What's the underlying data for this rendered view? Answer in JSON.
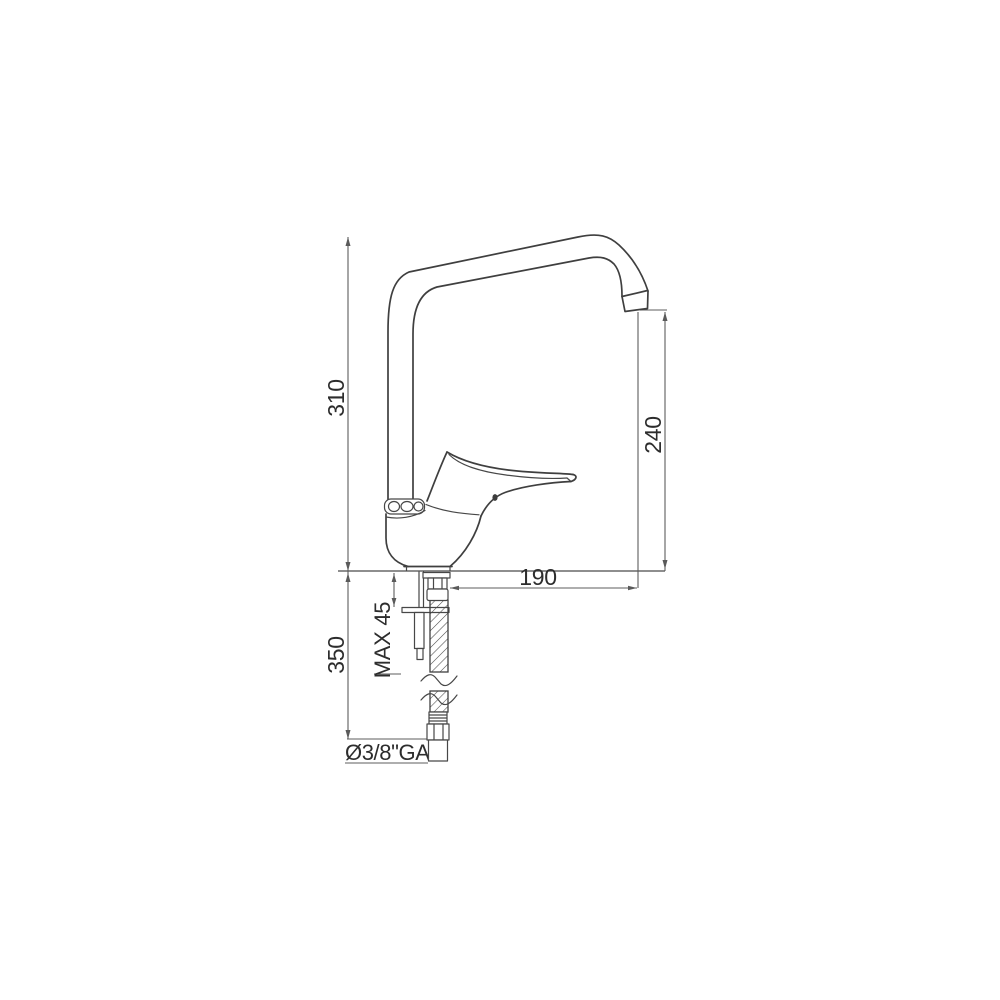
{
  "drawing": {
    "type": "faucet-technical-drawing",
    "labels": {
      "total_height": "310",
      "spout_height": "240",
      "spout_reach": "190",
      "max_deck_thickness": "MAX 45",
      "hose_length": "350",
      "connection_thread": "Ø3/8\"GAS"
    }
  }
}
